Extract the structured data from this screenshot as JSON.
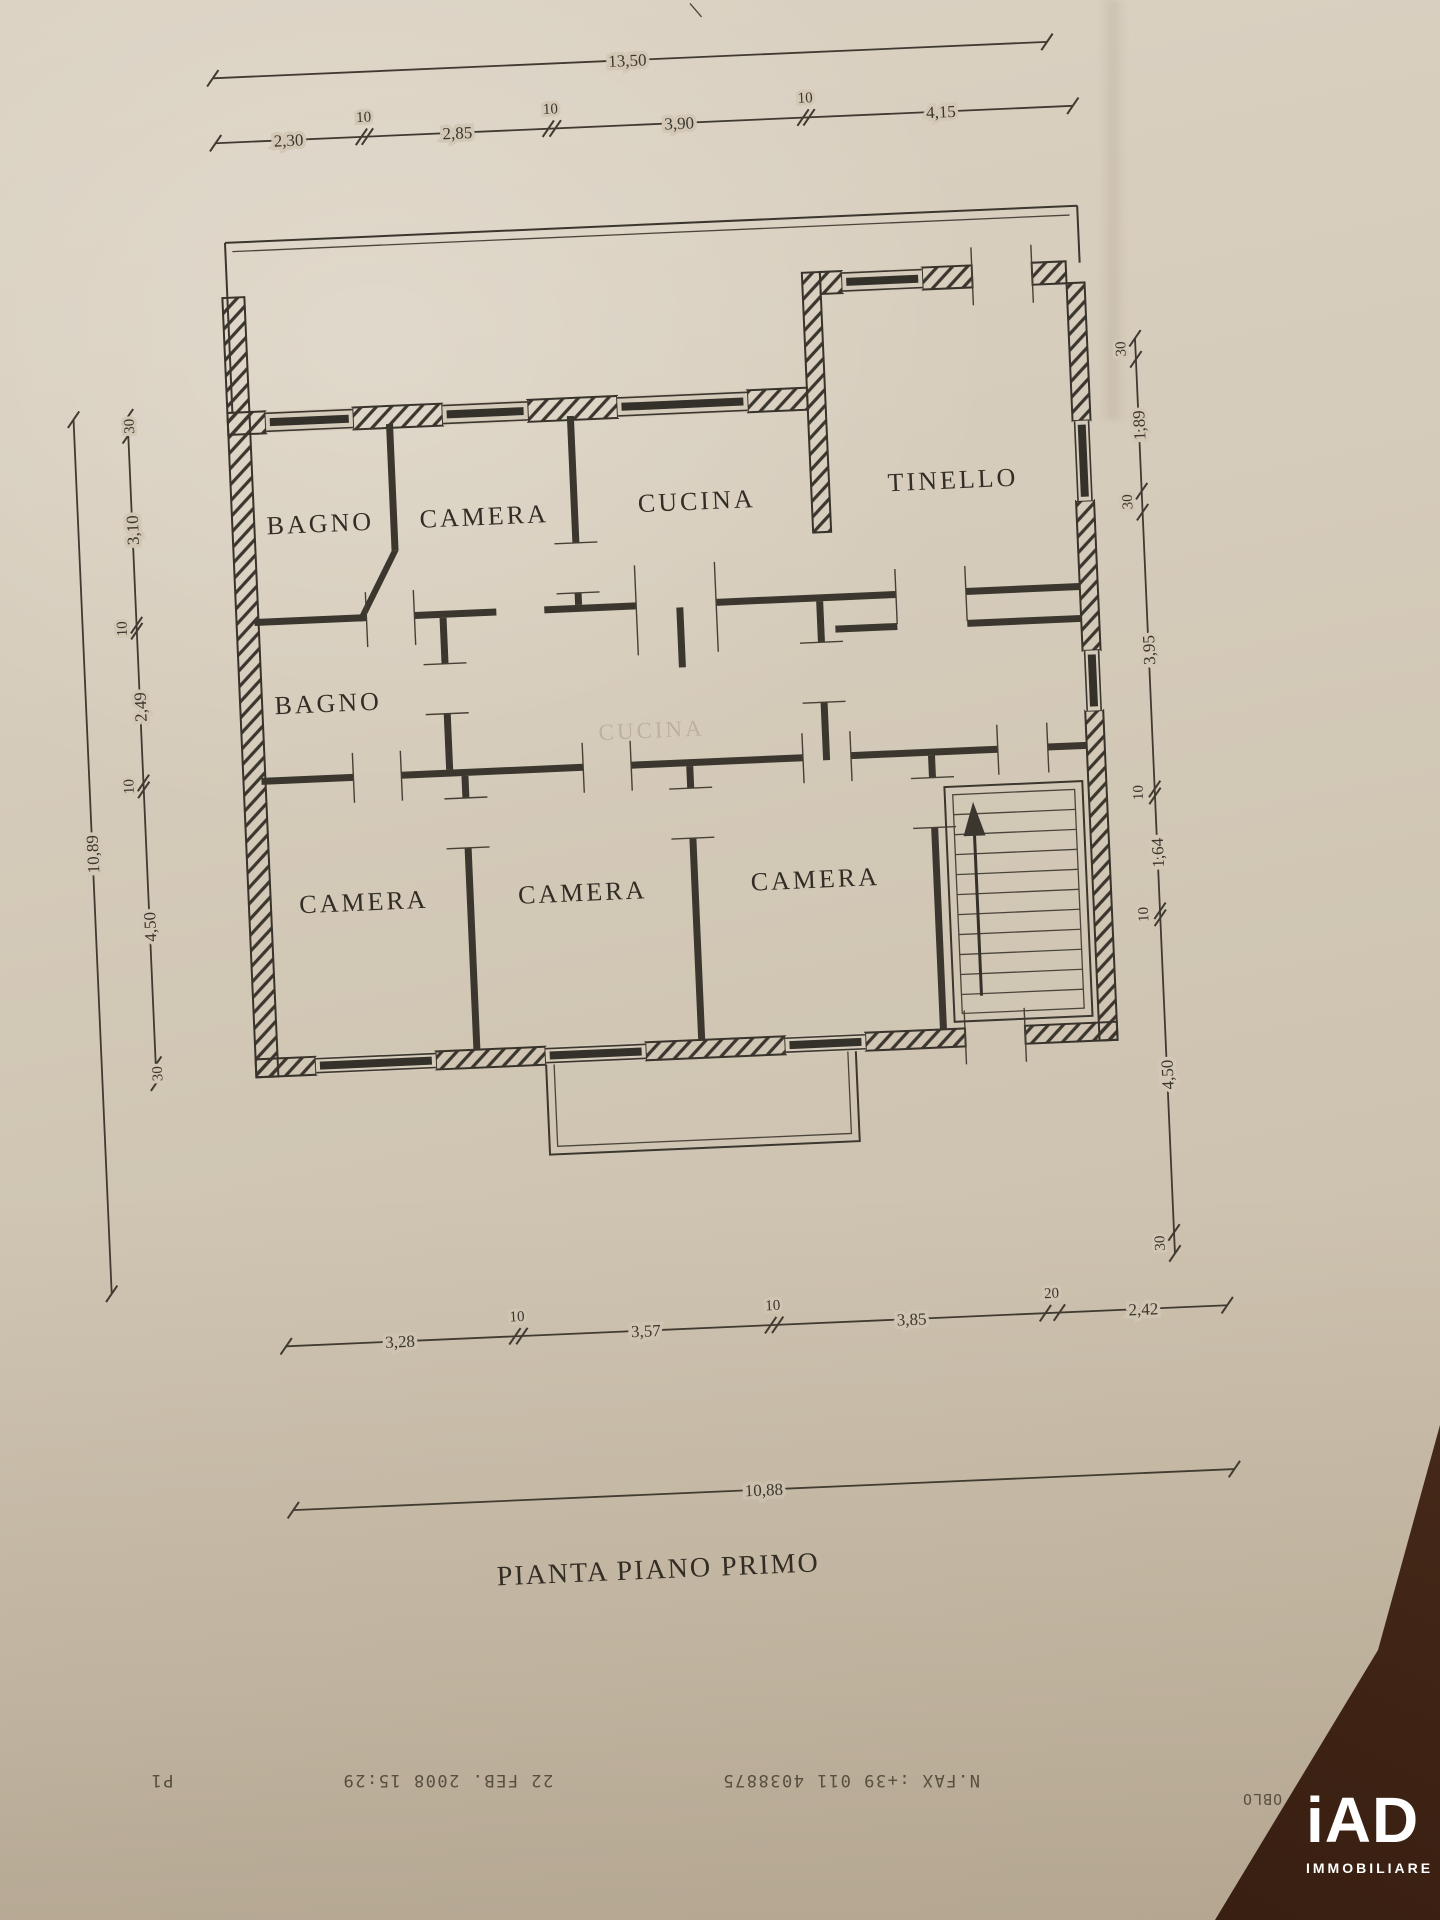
{
  "document": {
    "plan_title": "PIANTA PIANO PRIMO",
    "rooms": [
      "BAGNO",
      "CAMERA",
      "CUCINA",
      "TINELLO",
      "BAGNO",
      "CAMERA",
      "CAMERA",
      "CAMERA"
    ],
    "ghost_label": "CUCINA",
    "dimensions": {
      "top_total": "13,50",
      "top_segments": [
        "2,30",
        "10",
        "2,85",
        "10",
        "3,90",
        "10",
        "4,15"
      ],
      "left_total": "10,89",
      "left_segments": [
        "30",
        "3,10",
        "10",
        "2,49",
        "10",
        "4,50",
        "30"
      ],
      "right_segments": [
        "30",
        "1,89",
        "30",
        "3,95",
        "10",
        "1,64",
        "10",
        "4,50",
        "30"
      ],
      "bottom_segments": [
        "3,28",
        "10",
        "3,57",
        "10",
        "3,85",
        "20",
        "2,42"
      ],
      "bottom_total": "10,88"
    }
  },
  "fax": {
    "number_line": "N.FAX :+39 011 4038875",
    "datetime": "22 FEB. 2008 15:29",
    "page": "P1",
    "copy_tag": "1:COPY OBLO"
  },
  "logo": {
    "brand": "iAD",
    "subtitle": "IMMOBILIARE"
  },
  "colors": {
    "paper": "#d4cab8",
    "ink": "#3b362e",
    "desk": "#472a1a",
    "logo_white": "#ffffff"
  }
}
